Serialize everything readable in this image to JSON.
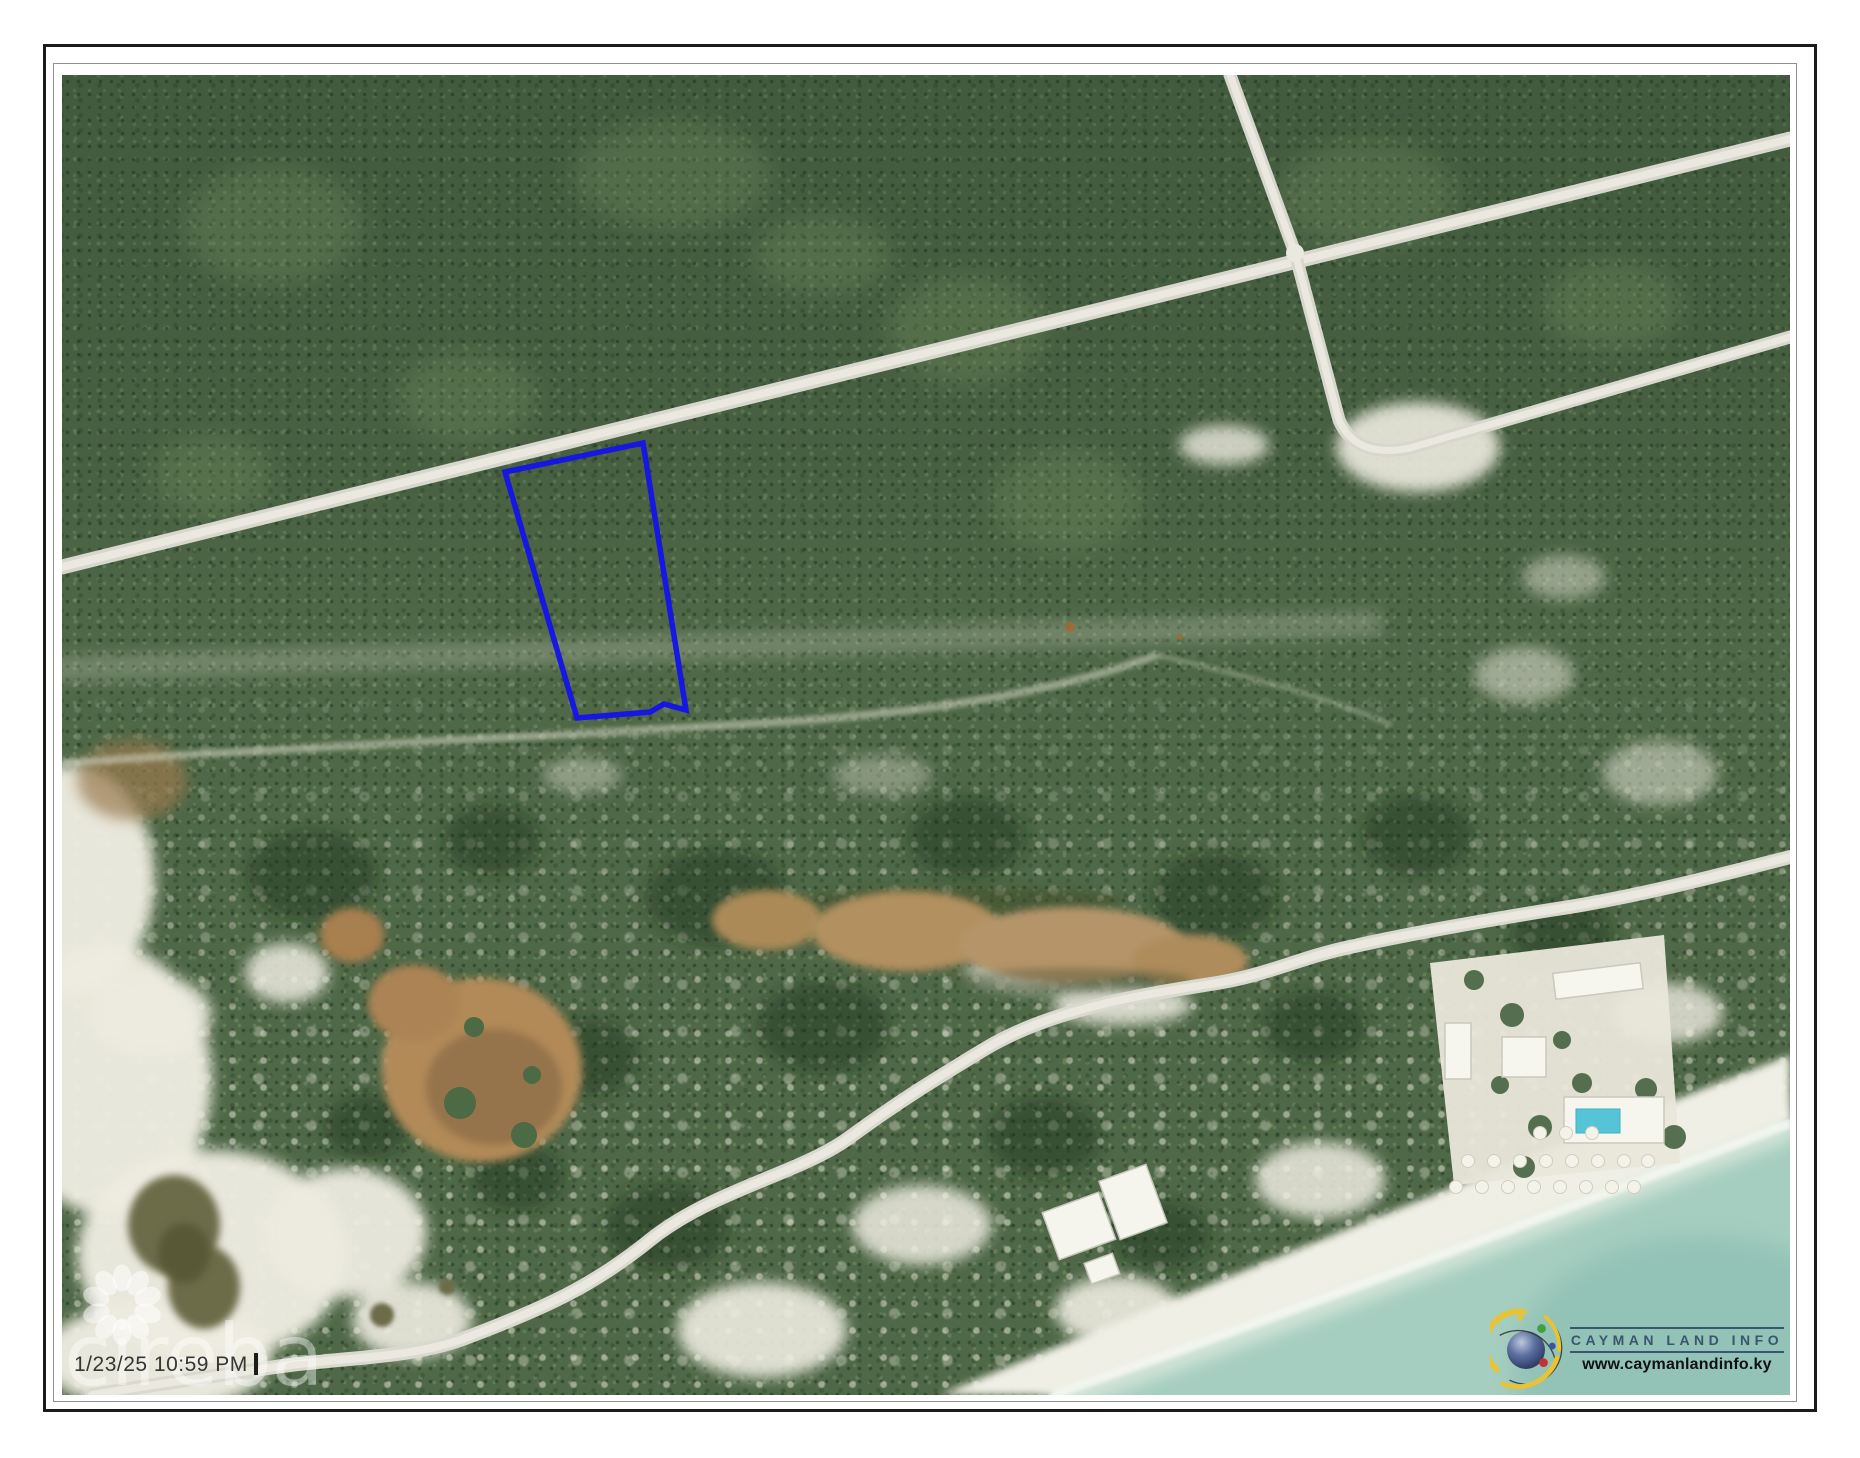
{
  "map": {
    "timestamp": "1/23/25 10:59 PM",
    "watermark": "cireba",
    "parcel": {
      "points": "443,397 581,368 624,635 602,629 588,637 515,643",
      "color": "#1414e8"
    },
    "branding": {
      "name": "CAYMAN LAND INFO",
      "website": "www.caymanlandinfo.ky",
      "name_color": "#3a566e",
      "website_color": "#111111",
      "arc_color": "#e8c435"
    },
    "colors": {
      "sea": "#a6cec0",
      "forest": "#4f6847",
      "road": "#d8d7ce",
      "sand": "#edebe0",
      "pond_brown": "#b18a58",
      "pool": "#55c4d6"
    }
  }
}
